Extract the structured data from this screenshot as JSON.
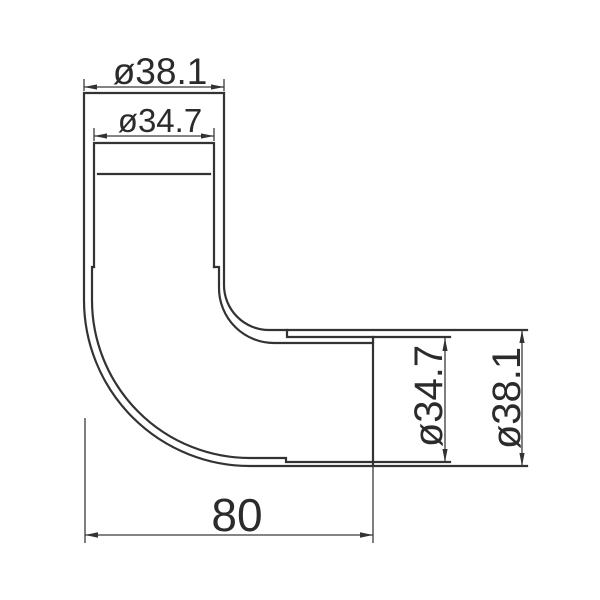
{
  "background": "#ffffff",
  "line_color": "#333333",
  "drawing": {
    "kind": "technical-dimension-drawing",
    "view": "elbow-fitting-section"
  },
  "dimensions": {
    "top_outer_diameter": {
      "label": "ø38.1",
      "value": 38.1,
      "orientation": "horizontal"
    },
    "top_inner_diameter": {
      "label": "ø34.7",
      "value": 34.7,
      "orientation": "horizontal"
    },
    "right_inner_diameter": {
      "label": "ø34.7",
      "value": 34.7,
      "orientation": "vertical"
    },
    "right_outer_diameter": {
      "label": "ø38.1",
      "value": 38.1,
      "orientation": "vertical"
    },
    "overall_length": {
      "label": "80",
      "value": 80,
      "orientation": "horizontal"
    }
  }
}
